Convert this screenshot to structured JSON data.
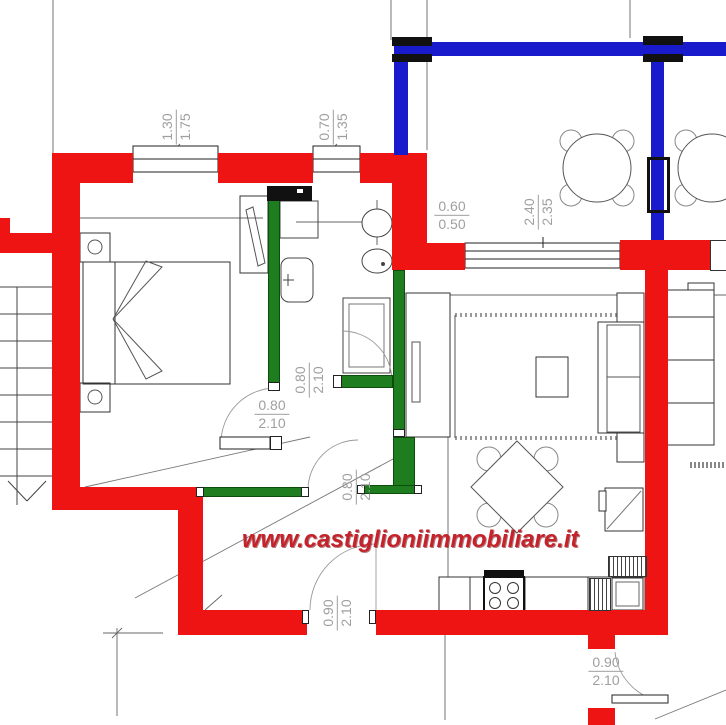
{
  "plan": {
    "watermark": "www.castiglioniimmobiliare.it",
    "colors": {
      "exterior_wall": "#ee1414",
      "interior_wall": "#1e7d1f",
      "terrace_wall": "#1a1acd",
      "watermark": "#c5232b",
      "dimension": "#9f9f9f"
    },
    "dimensions": [
      {
        "id": "window-left",
        "a": "1.30",
        "b": "1.75"
      },
      {
        "id": "window-mid",
        "a": "0.70",
        "b": "1.35"
      },
      {
        "id": "terrace-opening",
        "a": "0.60",
        "b": "0.50"
      },
      {
        "id": "terrace-window",
        "a": "2.40",
        "b": "2.35"
      },
      {
        "id": "door-bathroom",
        "a": "0.80",
        "b": "2.10"
      },
      {
        "id": "door-bedroom",
        "a": "0.80",
        "b": "2.10"
      },
      {
        "id": "door-hall",
        "a": "0.80",
        "b": "2.10"
      },
      {
        "id": "door-kitchen",
        "a": "0.90",
        "b": "2.10"
      },
      {
        "id": "door-entrance",
        "a": "0.90",
        "b": "2.10"
      }
    ]
  }
}
